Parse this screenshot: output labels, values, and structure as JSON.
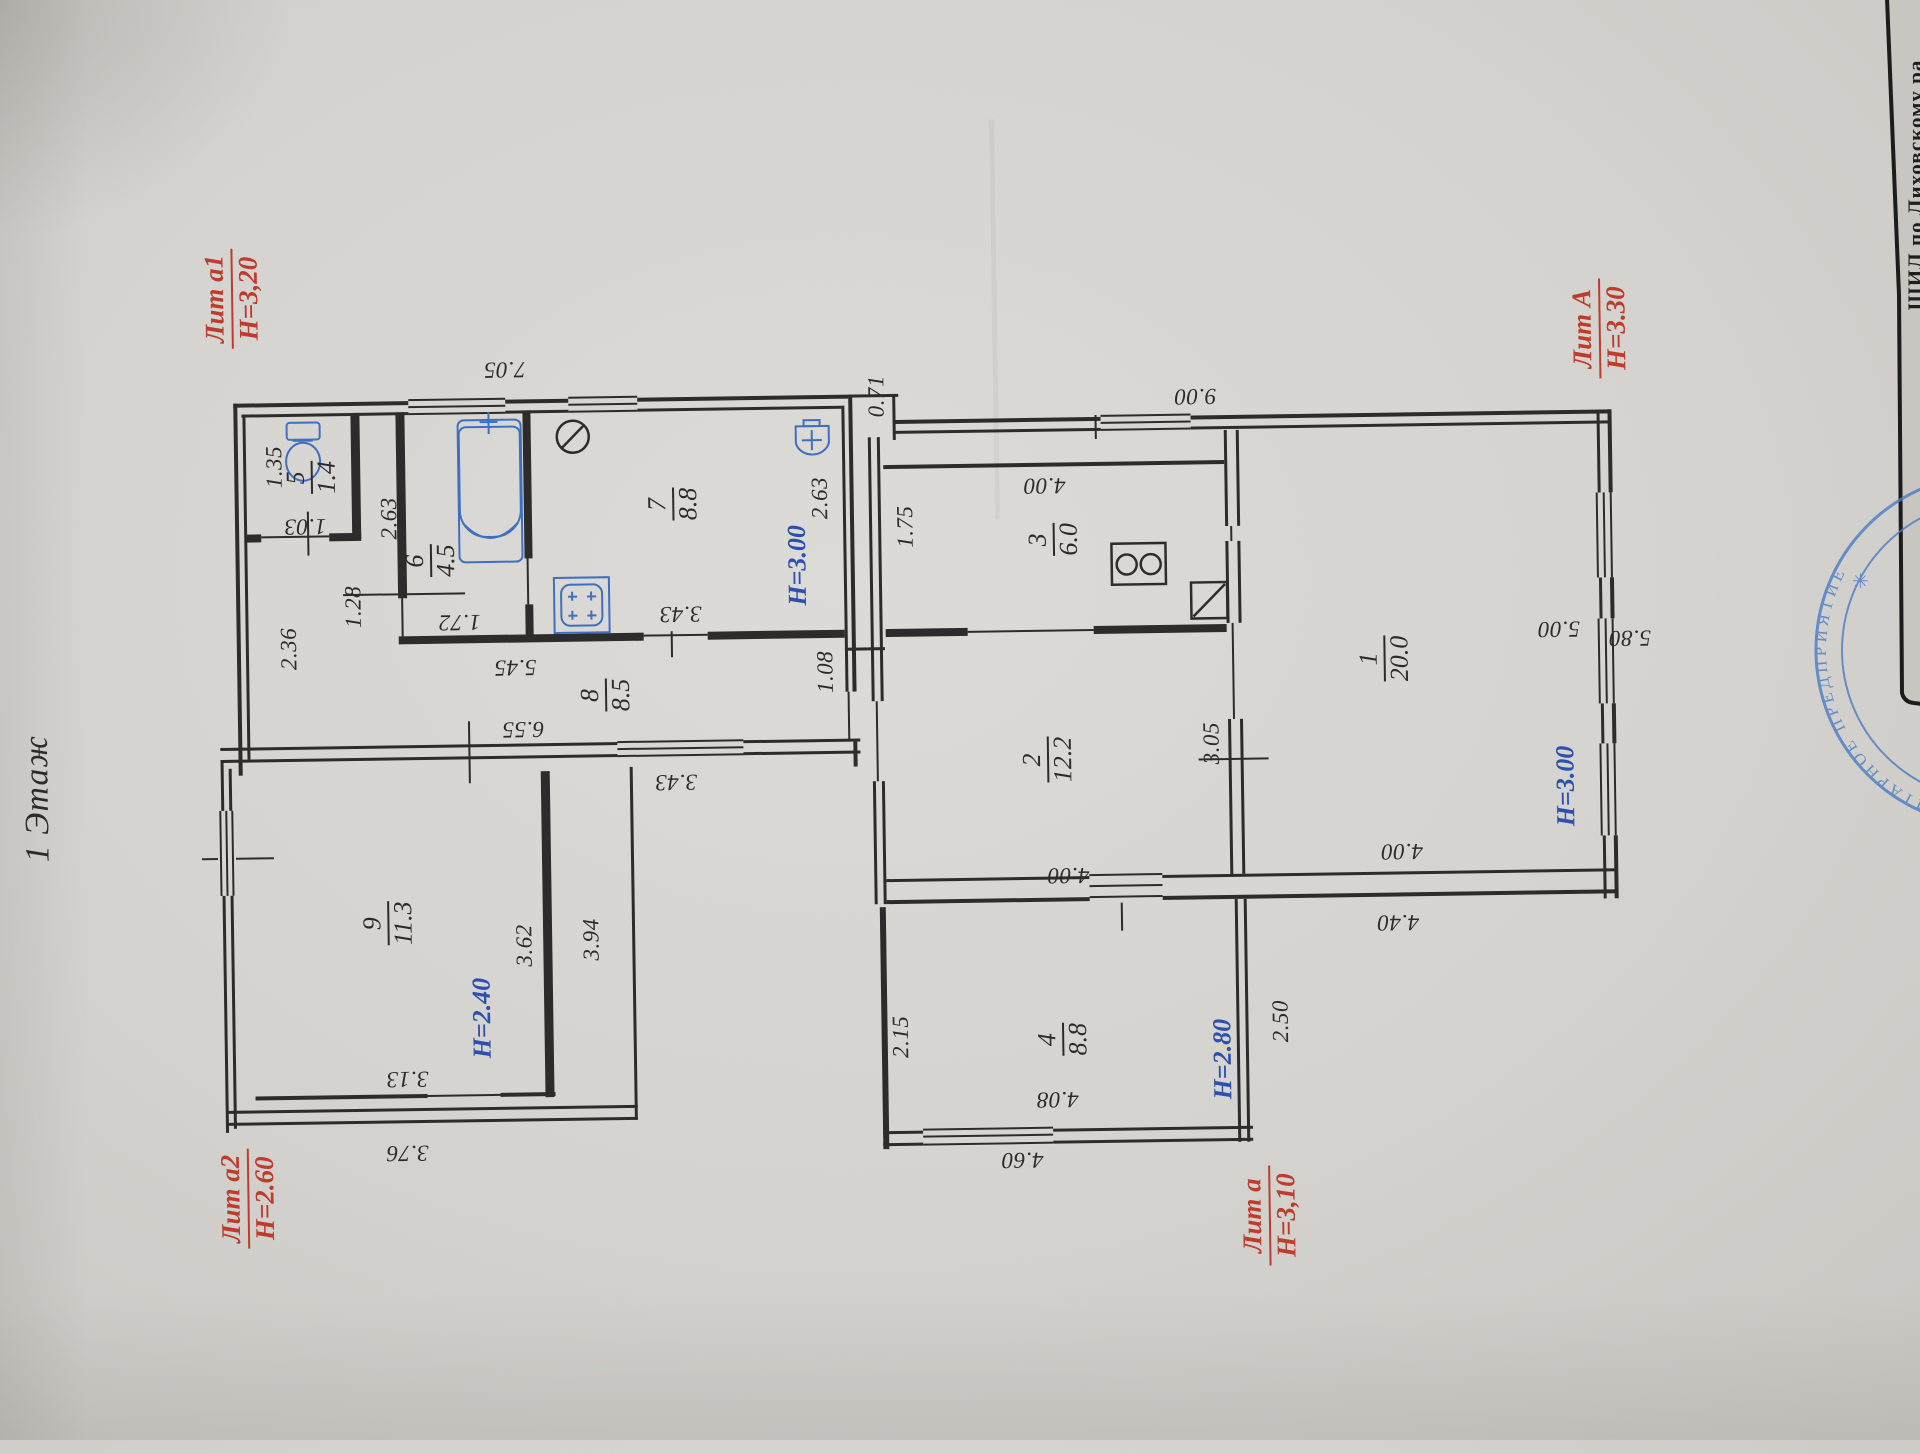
{
  "document": {
    "floor_label": "1 Этаж",
    "edge_text": "ШИЛ  по Лиховскому ра"
  },
  "colors": {
    "ink": "#2b2b2b",
    "red_title": "#bf3b2c",
    "blue_height": "#2d4fae",
    "fixture_blue": "#3f6fc0",
    "stamp_blue": "#4a7cc2",
    "paper": "#d8d6d2"
  },
  "section_titles": [
    {
      "line1": "Лит а1",
      "line2": "Н=3,20",
      "x": 238,
      "y": 288
    },
    {
      "line1": "Лит А",
      "line2": "Н=3.30",
      "x": 1605,
      "y": 338
    },
    {
      "line1": "Лит а",
      "line2": "Н=3,10",
      "x": 1262,
      "y": 1220
    },
    {
      "line1": "Лит а2",
      "line2": "Н=2.60",
      "x": 241,
      "y": 1188
    }
  ],
  "rooms": [
    {
      "number": "5",
      "area": "1.4",
      "x": 315,
      "y": 468
    },
    {
      "number": "6",
      "area": "4.5",
      "x": 433,
      "y": 553
    },
    {
      "number": "7",
      "area": "8.8",
      "x": 676,
      "y": 500
    },
    {
      "number": "8",
      "area": "8.5",
      "x": 606,
      "y": 690
    },
    {
      "number": "9",
      "area": "11.3",
      "x": 385,
      "y": 915
    },
    {
      "number": "3",
      "area": "6.0",
      "x": 1056,
      "y": 541
    },
    {
      "number": "2",
      "area": "12.2",
      "x": 1047,
      "y": 761
    },
    {
      "number": "1",
      "area": "20.0",
      "x": 1385,
      "y": 665
    },
    {
      "number": "4",
      "area": "8.8",
      "x": 1058,
      "y": 1041
    }
  ],
  "heights": [
    {
      "text": "Н=3.00",
      "x": 800,
      "y": 563
    },
    {
      "text": "Н=3.00",
      "x": 1565,
      "y": 795
    },
    {
      "text": "Н=2.80",
      "x": 1218,
      "y": 1063
    },
    {
      "text": "Н=2.40",
      "x": 478,
      "y": 1011
    }
  ],
  "dimensions": [
    {
      "text": "1.35",
      "x": 278,
      "y": 457,
      "dir": "up"
    },
    {
      "text": "2.63",
      "x": 392,
      "y": 510,
      "dir": "up"
    },
    {
      "text": "1.28",
      "x": 355,
      "y": 598,
      "dir": "up"
    },
    {
      "text": "2.36",
      "x": 290,
      "y": 639,
      "dir": "up"
    },
    {
      "text": "2.63",
      "x": 823,
      "y": 496,
      "dir": "up"
    },
    {
      "text": "0.71",
      "x": 881,
      "y": 395,
      "dir": "up"
    },
    {
      "text": "1.75",
      "x": 908,
      "y": 526,
      "dir": "up"
    },
    {
      "text": "1.08",
      "x": 826,
      "y": 670,
      "dir": "up"
    },
    {
      "text": "2.15",
      "x": 896,
      "y": 1036,
      "dir": "up"
    },
    {
      "text": "3.05",
      "x": 1211,
      "y": 747,
      "dir": "up"
    },
    {
      "text": "2.50",
      "x": 1276,
      "y": 1026,
      "dir": "up"
    },
    {
      "text": "3.62",
      "x": 521,
      "y": 939,
      "dir": "up"
    },
    {
      "text": "3.94",
      "x": 588,
      "y": 934,
      "dir": "up"
    },
    {
      "text": "7.05",
      "x": 510,
      "y": 363,
      "dir": "flip"
    },
    {
      "text": "1.03",
      "x": 308,
      "y": 517,
      "dir": "flip"
    },
    {
      "text": "1.72",
      "x": 461,
      "y": 615,
      "dir": "flip"
    },
    {
      "text": "3.43",
      "x": 682,
      "y": 610,
      "dir": "flip"
    },
    {
      "text": "5.45",
      "x": 516,
      "y": 661,
      "dir": "flip"
    },
    {
      "text": "6.55",
      "x": 523,
      "y": 723,
      "dir": "flip"
    },
    {
      "text": "3.43",
      "x": 675,
      "y": 778,
      "dir": "flip"
    },
    {
      "text": "9.00",
      "x": 1200,
      "y": 400,
      "dir": "flip"
    },
    {
      "text": "4.00",
      "x": 1048,
      "y": 487,
      "dir": "flip"
    },
    {
      "text": "4.00",
      "x": 1066,
      "y": 877,
      "dir": "flip"
    },
    {
      "text": "4.00",
      "x": 1400,
      "y": 858,
      "dir": "flip"
    },
    {
      "text": "4.40",
      "x": 1395,
      "y": 929,
      "dir": "flip"
    },
    {
      "text": "4.08",
      "x": 1052,
      "y": 1101,
      "dir": "flip"
    },
    {
      "text": "4.60",
      "x": 1016,
      "y": 1161,
      "dir": "flip"
    },
    {
      "text": "3.13",
      "x": 402,
      "y": 1071,
      "dir": "flip"
    },
    {
      "text": "3.76",
      "x": 401,
      "y": 1145,
      "dir": "flip"
    },
    {
      "text": "5.00",
      "x": 1560,
      "y": 638,
      "dir": "flip"
    },
    {
      "text": "5.80",
      "x": 1631,
      "y": 648,
      "dir": "flip"
    }
  ],
  "stamp": {
    "arc_text": "УНИТАРНОЕ ПРЕДПРИЯТИЕ",
    "star": "✳"
  },
  "fixture_icons": [
    "bathtub-icon",
    "toilet-icon",
    "sink-icon",
    "water-heater-icon",
    "gas-stove-icon",
    "stove-2-burner-icon",
    "flue-icon"
  ]
}
